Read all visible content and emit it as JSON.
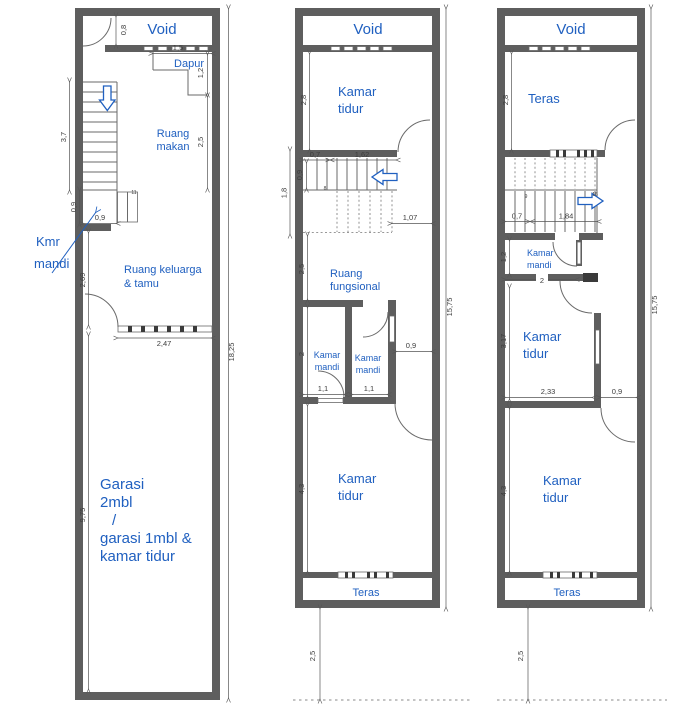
{
  "colors": {
    "wall": "#5e5e5e",
    "blue": "#2060c0",
    "dim": "#555555"
  },
  "plan_left": {
    "rooms": {
      "void": "Void",
      "dapur": "Dapur",
      "makan1": "Ruang",
      "makan2": "makan",
      "kmr1": "Kmr",
      "kmr2": "mandi",
      "keluarga1": "Ruang keluarga",
      "keluarga2": "& tamu",
      "garasi1": "Garasi",
      "garasi2": "2mbl",
      "garasi3": "/",
      "garasi4": "garasi 1mbl &",
      "garasi5": "kamar tidur"
    },
    "dims": {
      "void_h": "0,8",
      "dapur_w": "1,5",
      "dapur_h": "1,2",
      "makan_h": "2,5",
      "stairs_h": "3,7",
      "kmr_h": "0,9",
      "kmr_w": "0,9",
      "keluarga_h": "2,69",
      "keluarga_w": "2,47",
      "garasi_h": "9,75",
      "total_h": "18,25"
    },
    "stair_count": "11"
  },
  "plan_middle": {
    "rooms": {
      "void": "Void",
      "tidur_atas1": "Kamar",
      "tidur_atas2": "tidur",
      "fungsional1": "Ruang",
      "fungsional2": "fungsional",
      "mandi_kiri1": "Kamar",
      "mandi_kiri2": "mandi",
      "mandi_kanan1": "Kamar",
      "mandi_kanan2": "mandi",
      "tidur_bawah1": "Kamar",
      "tidur_bawah2": "tidur",
      "teras": "Teras"
    },
    "dims": {
      "tidur_h": "2,8",
      "stairs_a": "0,7",
      "stairs_b": "1,62",
      "stairs_w": "0,9",
      "stairs_bay": "1,8",
      "landing": "1,07",
      "fungsional_h": "2,5",
      "mandi_h": "2",
      "mandi_kiri_w": "1,1",
      "mandi_kanan_w": "1,1",
      "koridor_w": "0,9",
      "tidur_bawah_h": "4,3",
      "total_h": "15,75",
      "setback": "2,5"
    },
    "stair_count": "8"
  },
  "plan_right": {
    "rooms": {
      "void": "Void",
      "teras_atas": "Teras",
      "mandi1": "Kamar",
      "mandi2": "mandi",
      "tidur_tengah1": "Kamar",
      "tidur_tengah2": "tidur",
      "tidur_bawah1": "Kamar",
      "tidur_bawah2": "tidur",
      "teras_bawah": "Teras"
    },
    "dims": {
      "teras_h": "2,8",
      "stairs_a": "0,7",
      "stairs_b": "1,84",
      "mandi_h": "1,2",
      "mandi_w": "2",
      "tidur_tengah_h": "3,17",
      "tidur_tengah_w": "2,33",
      "koridor_w": "0,9",
      "tidur_bawah_h": "4,3",
      "total_h": "15,75",
      "setback": "2,5"
    },
    "stair_counts": {
      "top": "16",
      "mid": "9"
    }
  }
}
